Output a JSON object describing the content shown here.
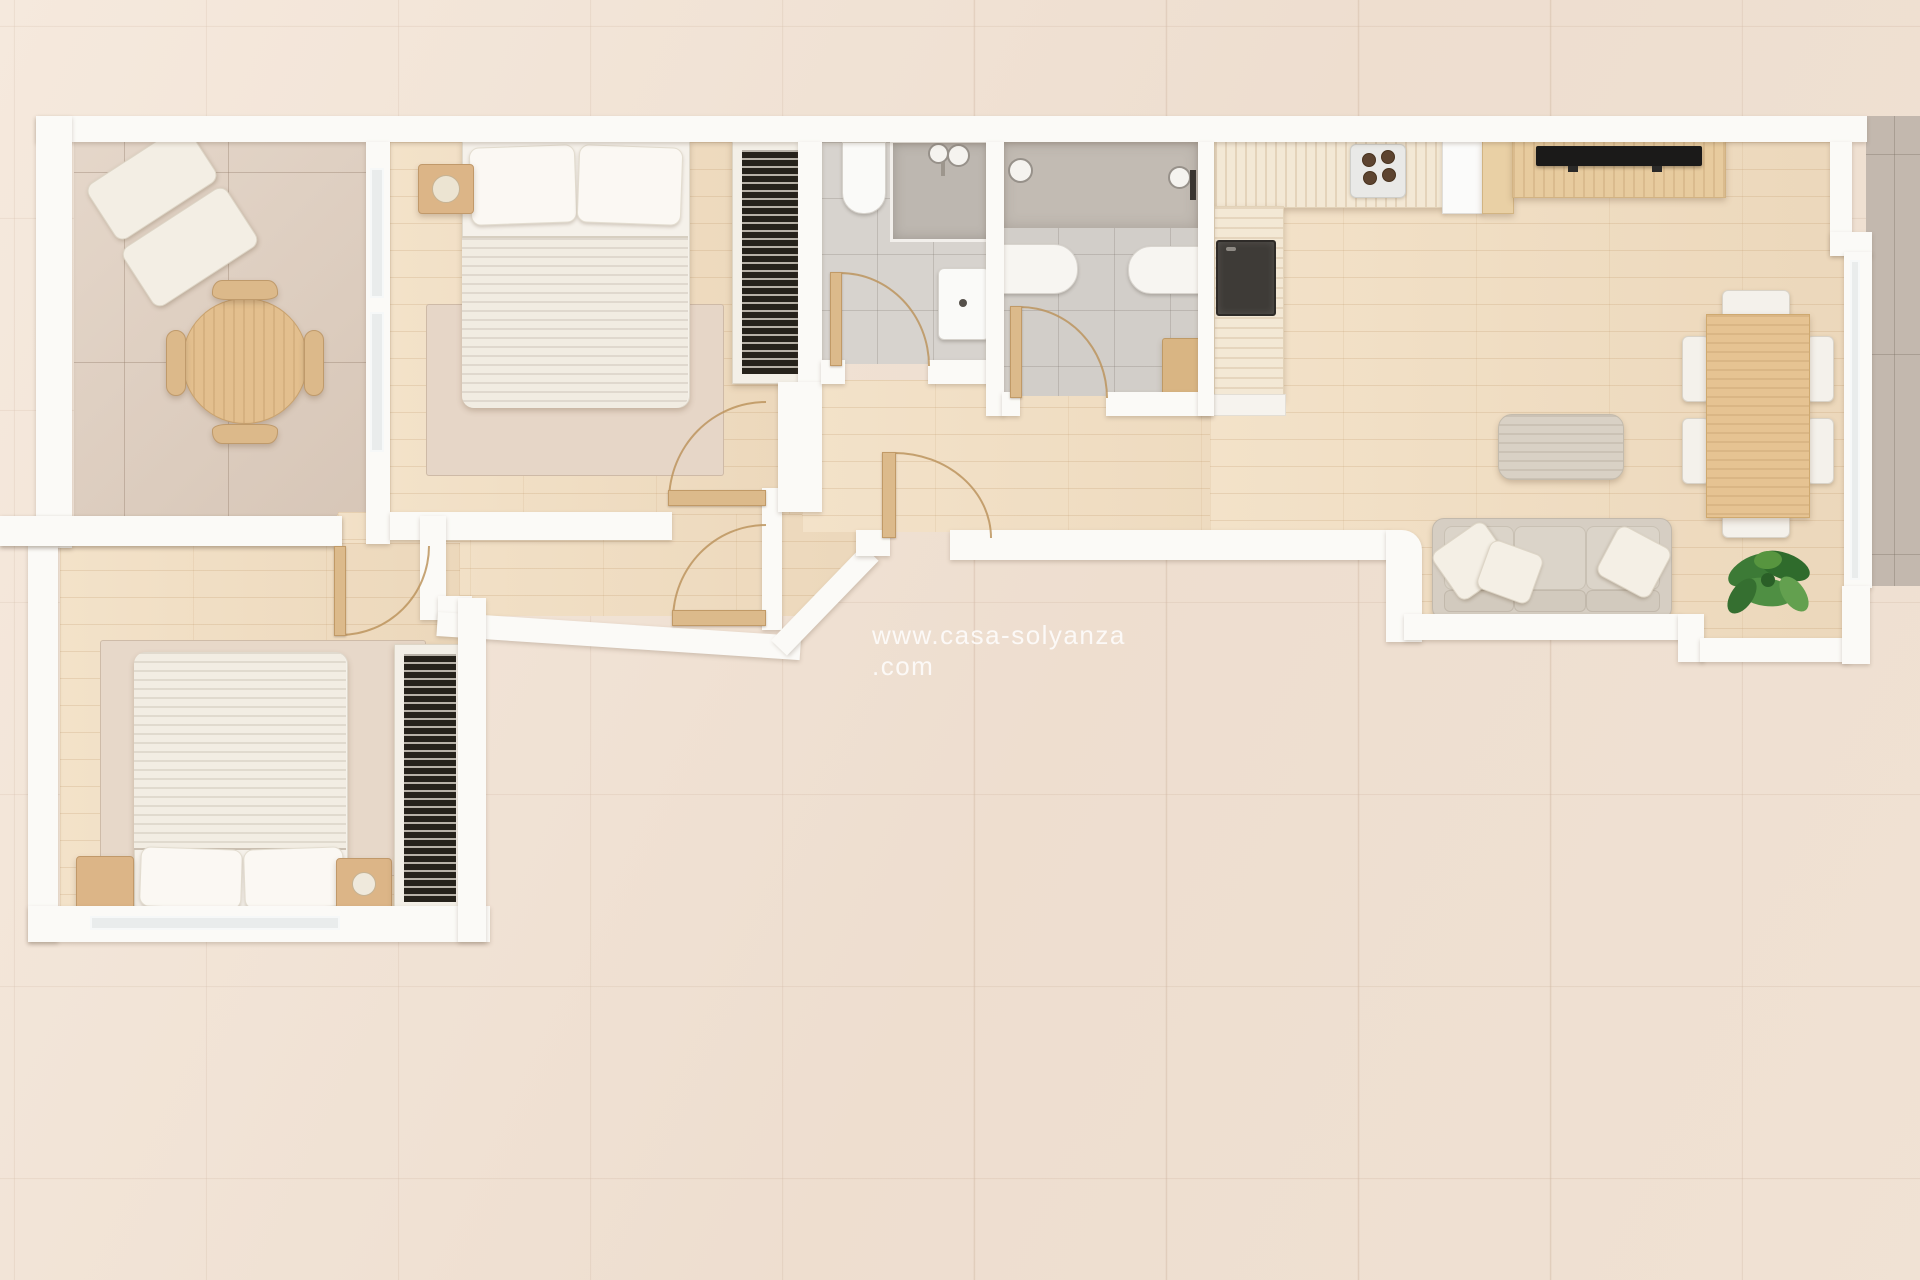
{
  "watermark": {
    "text": "www.casa-solyanza .com"
  },
  "scene": {
    "type": "3d-floor-plan-top-view",
    "description": "Rendered top-down floor plan of a two-bedroom apartment with terrace, two bathrooms, hallway and open kitchen-living room"
  },
  "palette": {
    "exterior_tile": "#f0e2d4",
    "exterior_tile_gray": "#c3b8ae",
    "terrace_tile": "#ddcdbf",
    "wood_floor": "#efdcc0",
    "wall_white": "#fbfaf7",
    "bathroom_tile": "#d7d3ce",
    "shower_tile": "#bdb7b0",
    "furniture_wood": "#e3bf8e",
    "textile_beige": "#d6cec3",
    "linen_white": "#f5f1ea",
    "radiator_dark": "#26221b",
    "tv_black": "#1b1a19",
    "plant_green": "#3c7a36"
  },
  "rooms": [
    {
      "id": "terrace-dining",
      "furniture": [
        "lounge-chair",
        "round-dining-table",
        "four-chairs"
      ]
    },
    {
      "id": "bedroom-1",
      "furniture": [
        "double-bed",
        "pillows",
        "nightstand",
        "lamp",
        "rug",
        "radiator",
        "door"
      ]
    },
    {
      "id": "bathroom-1",
      "furniture": [
        "toilet",
        "shower",
        "washbasin",
        "door"
      ]
    },
    {
      "id": "bathroom-2",
      "furniture": [
        "shower-heads",
        "toilet",
        "bidet",
        "vanity-cabinet",
        "door"
      ]
    },
    {
      "id": "kitchen",
      "furniture": [
        "counter-l-shape",
        "gas-hob",
        "sink",
        "fridge",
        "cabinet"
      ]
    },
    {
      "id": "living-room",
      "furniture": [
        "tv-sideboard",
        "tv",
        "pouf",
        "dining-table",
        "six-chairs",
        "sofa",
        "pillows",
        "plant"
      ]
    },
    {
      "id": "bedroom-2",
      "furniture": [
        "double-bed",
        "pillows",
        "two-nightstands",
        "rug",
        "radiator",
        "door"
      ]
    },
    {
      "id": "hallway",
      "furniture": [
        "front-door",
        "interior-doors"
      ]
    }
  ]
}
